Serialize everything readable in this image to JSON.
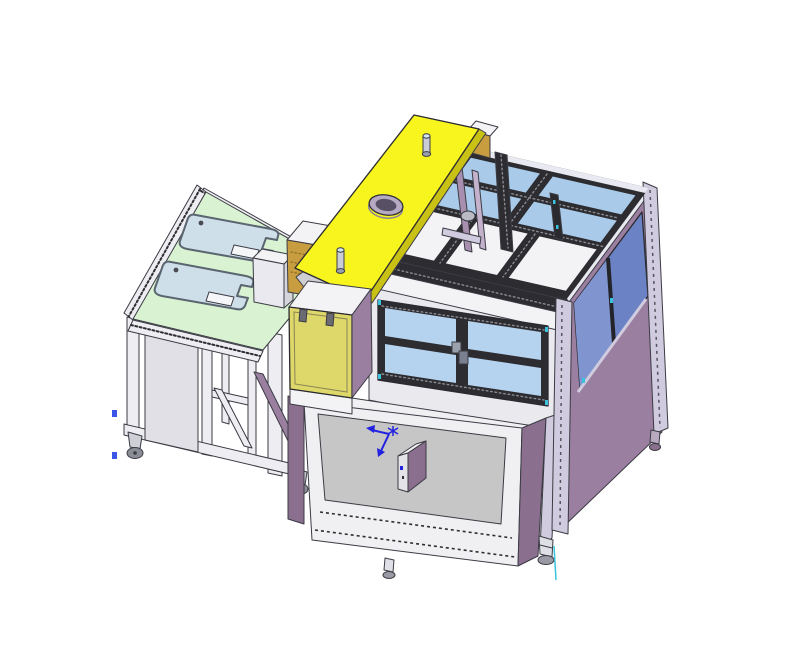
{
  "viewport": {
    "width": 800,
    "height": 653
  },
  "scene_type": "3d-cad-isometric-render",
  "components": [
    "infeed-table-with-pallet-trays",
    "pallet-tray-1",
    "pallet-tray-2",
    "tan-feeder-box",
    "yellow-chute-plate",
    "chute-port-ring",
    "locating-pin-1",
    "locating-pin-2",
    "machine-enclosure-top-frame",
    "top-glass-panes",
    "top-white-panels",
    "front-window-2x2",
    "window-handle",
    "right-wall-glass",
    "right-side-purple-skirt",
    "yellow-access-door",
    "door-hinges",
    "base-tub-panel",
    "junction-box",
    "origin-triad",
    "caster-wheels",
    "leveling-feet"
  ],
  "colors": {
    "background": "#ffffff",
    "outline": "#3b3b44",
    "table_top": "#d9f2d2",
    "tray": "#cfdfe9",
    "tray_slot": "#f4f6f8",
    "frame_white": "#ededf2",
    "panel_white": "#f3f3f6",
    "under_panel": "#e0e0e6",
    "backing_white": "#e9e9ee",
    "ledge_white": "#f0f0f3",
    "purple_panel": "#9b7fa0",
    "purple_dark": "#8a6f8e",
    "lavender": "#d0cbde",
    "lavender_band": "#e9e9f2",
    "dark_frame": "#2c2c31",
    "glass_top": "#a9cbe9",
    "glass_front": "#b5d2ee",
    "glass_right": "#6b83c4",
    "glass_right_light": "#8094cf",
    "yellow_plate": "#f8f51e",
    "yellow_plate_edge": "#c9c214",
    "yellow_door": "#ded76a",
    "tan_box": "#c79d3f",
    "tan_dark": "#a8842f",
    "base_gray": "#c6c6c6",
    "caster_gray": "#8b8d96",
    "caster_bracket": "#cfd0d6",
    "port_outer": "#b6a9c2",
    "port_inner": "#574f63",
    "pin_body": "#c9cdd8",
    "pin_top": "#cfe6f2",
    "pin_base": "#9aa0ad",
    "hinge_gray": "#6a6a72",
    "wedge_gray": "#cfcfd3",
    "white_box_front": "#e9e9ef",
    "white_box_side": "#d5d5dc",
    "mech_purple_1": "#a88fb0",
    "mech_purple_2": "#c4b2cc",
    "disc_gray": "#b9bac4",
    "handle_top": "#9aa0ac",
    "handle_bottom": "#7a8090",
    "box_face": "#e3e3e8",
    "foot_stem": "#dfe0e6",
    "foot_base": "#9a9aa4",
    "triad_blue": "#2222e0",
    "cyan_accent": "#39c3dc",
    "datum_blue": "#3a55e8"
  }
}
